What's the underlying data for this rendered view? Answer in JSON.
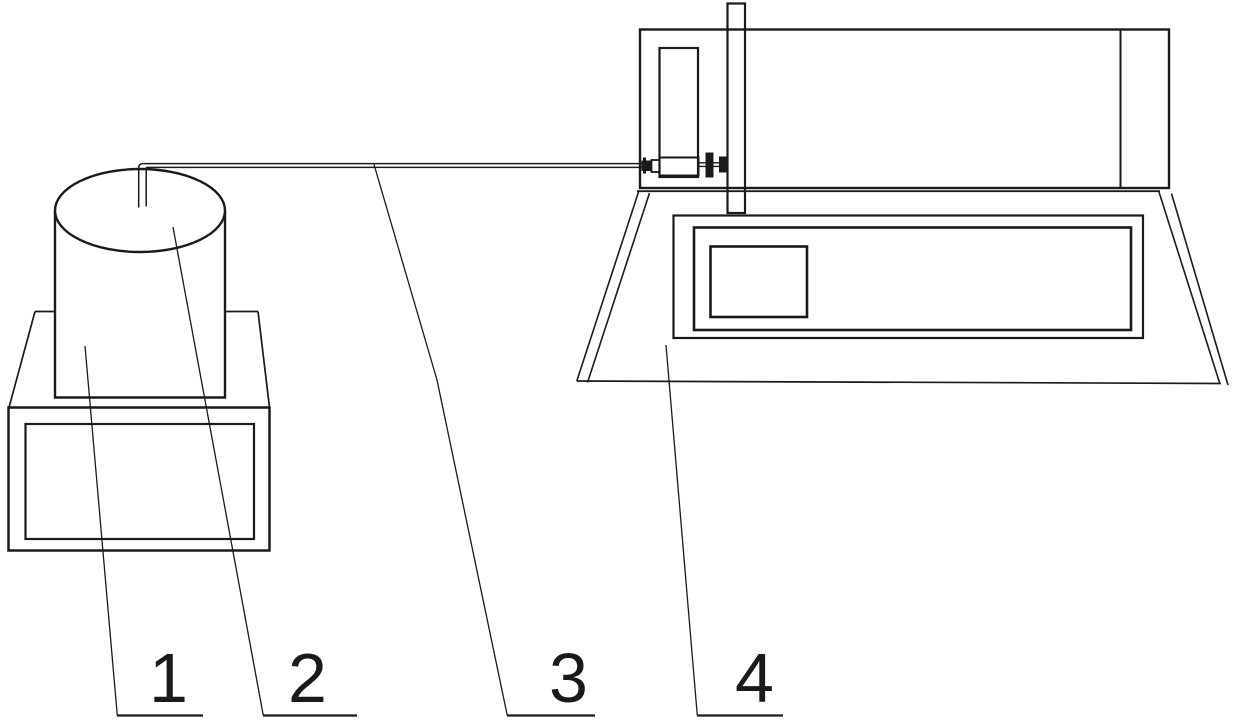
{
  "drawing": {
    "background_color": "#ffffff",
    "stroke_color": "#1a1a1a",
    "callouts": [
      {
        "label": "1"
      },
      {
        "label": "2"
      },
      {
        "label": "3"
      },
      {
        "label": "4"
      }
    ]
  }
}
